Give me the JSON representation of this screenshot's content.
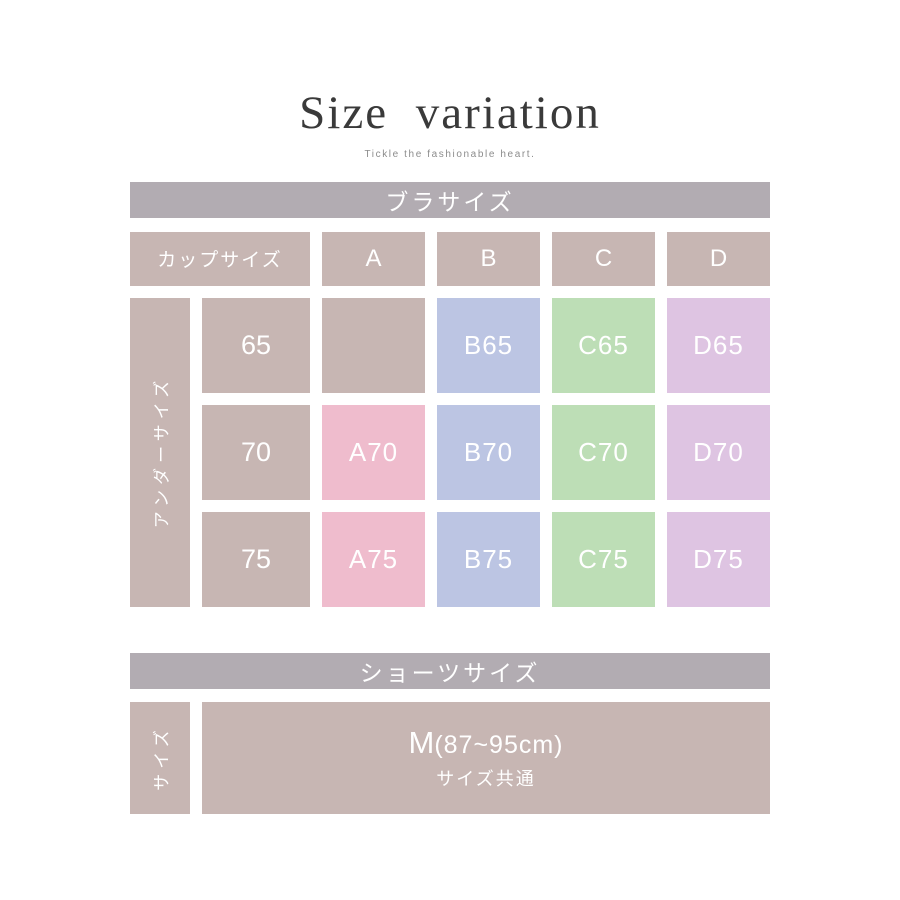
{
  "title": "Size variation",
  "subtitle": "Tickle the fashionable heart.",
  "bra": {
    "header": "ブラサイズ",
    "cup_label": "カップサイズ",
    "under_label": "アンダーサイズ",
    "cups": {
      "a": "A",
      "b": "B",
      "c": "C",
      "d": "D"
    },
    "rows": [
      {
        "under": "65",
        "a": "",
        "b": "B65",
        "c": "C65",
        "d": "D65"
      },
      {
        "under": "70",
        "a": "A70",
        "b": "B70",
        "c": "C70",
        "d": "D70"
      },
      {
        "under": "75",
        "a": "A75",
        "b": "B75",
        "c": "C75",
        "d": "D75"
      }
    ]
  },
  "shorts": {
    "header": "ショーツサイズ",
    "size_label": "サイズ",
    "size_main": "M",
    "size_range": "(87~95cm)",
    "size_note": "サイズ共通"
  },
  "colors": {
    "bar_gray": "#b2acb2",
    "taupe": "#c7b6b3",
    "cup_a_pink": "#efbccd",
    "cup_b_blue": "#bcc5e3",
    "cup_c_green": "#bddeb6",
    "cup_d_purple": "#dec4e2",
    "text_white": "#ffffff",
    "title_text": "#3a3a3a",
    "subtitle_text": "#8c8c8c"
  }
}
